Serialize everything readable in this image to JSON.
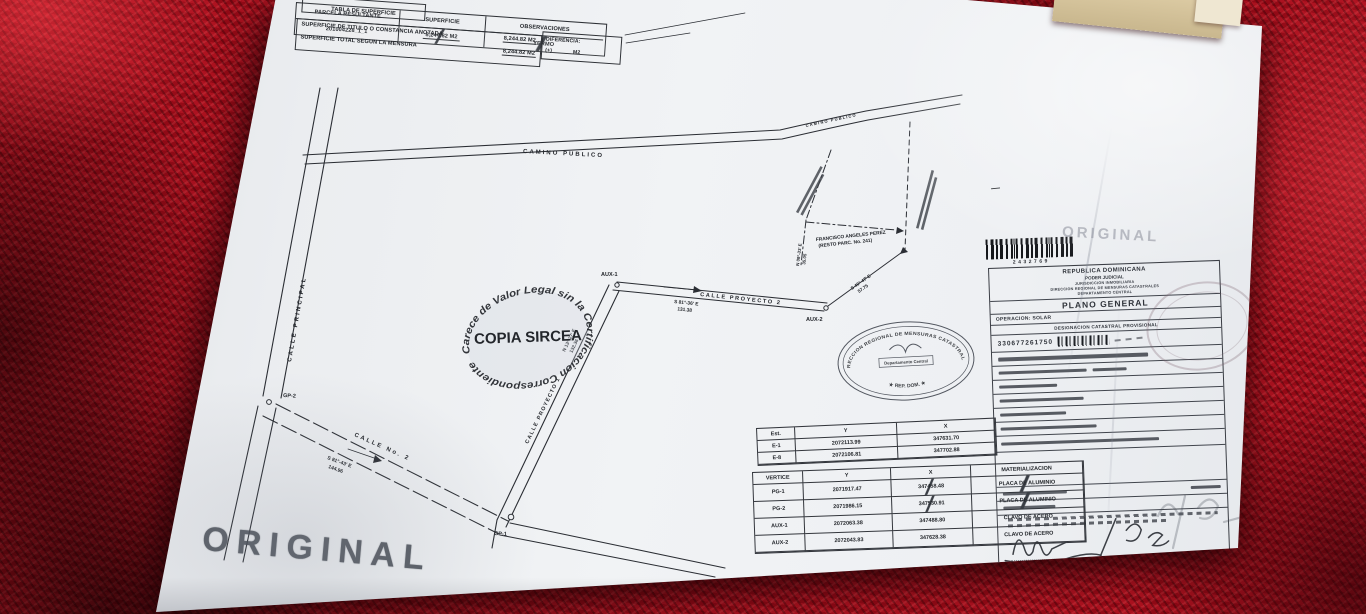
{
  "doc": {
    "title_box": "TABLA DE SUPERFICIE",
    "titulo_label": "SUPERFICIE DE TITULO O CONSTANCIA ANOTADA",
    "titulo_value": "8,244.82 M2",
    "mensura_label": "SUPERFICIE TOTAL SEGUN LA MENSURA",
    "mensura_value": "8,244.82 M2",
    "dif_label": "DIFERENCIA:",
    "dif_value": "(+) ______ M2",
    "h_parcela": "PARCELA RESULTANTE",
    "h_superficie": "SUPERFICIE",
    "h_obs": "OBSERVACIONES",
    "v_parcela": "201004228_1_1",
    "v_superficie": "8,244.82 M2",
    "v_obs": "YERMO"
  },
  "map": {
    "streets": {
      "camino": "CAMINO PUBLICO",
      "principal": "CALLE PRINCIPAL",
      "no2": "CALLE No. 2",
      "proy1": "CALLE PROYECTO 1",
      "proy2": "CALLE PROYECTO 2"
    },
    "points": {
      "gp1": "GP-1",
      "gp2": "GP-2",
      "aux1": "AUX-1",
      "aux2": "AUX-2"
    },
    "bearings": {
      "no2": {
        "b": "S 81°-43' E",
        "d": "144.96"
      },
      "proy1": {
        "b": "N 13°-27' E",
        "d": "132.36"
      },
      "proy2": {
        "b": "S 81°-36' E",
        "d": "131.38"
      },
      "diag": {
        "b": "S 46°-47' E",
        "d": "57.75"
      },
      "west": {
        "b": "N 09°-33' E",
        "d": "35.05"
      }
    },
    "neighbor": {
      "l1": "FRANCISCO ANGELES PEREZ",
      "l2": "(RESTO PARC. No. 241)"
    },
    "compass_n": "N"
  },
  "stamps": {
    "copia_arc": "Carece de Valor Legal sin la Certificacion Correspondiente",
    "copia_center": "COPIA SIRCEA",
    "seal_arc_top": "DIRECCION REGIONAL DE MENSURAS CATASTRALES",
    "seal_arc_bottom": "★ REP. DOM. ★",
    "seal_center": "Departamento Central",
    "original": "ORIGINAL"
  },
  "barcode": {
    "number": "2432769"
  },
  "panel": {
    "lines": [
      "REPUBLICA DOMINICANA",
      "PODER JUDICIAL",
      "JURISDICCION INMOBILIARIA",
      "DIRECCION REGIONAL DE MENSURAS CATASTRALES",
      "DEPARTAMENTO CENTRAL"
    ],
    "title": "PLANO GENERAL",
    "operacion": "OPERACION: SOLAR",
    "designacion": "DESIGNACION CATASTRAL PROVISIONAL",
    "numero": "330677261750",
    "agrimensor": "AGRIMENSOR"
  },
  "tables": {
    "est": {
      "headers": [
        "Est.",
        "Y",
        "X"
      ],
      "rows": [
        [
          "E-1",
          "2072113.99",
          "347631.70"
        ],
        [
          "E-8",
          "2072106.81",
          "347702.88"
        ]
      ]
    },
    "vert": {
      "headers": [
        "VERTICE",
        "Y",
        "X",
        "MATERIALIZACION"
      ],
      "rows": [
        [
          "PG-1",
          "2071917.47",
          "347458.48",
          "PLACA DE ALUMINIO"
        ],
        [
          "PG-2",
          "2071986.15",
          "347530.91",
          "PLACA DE ALUMINIO"
        ],
        [
          "AUX-1",
          "2072063.38",
          "347488.80",
          "CLAVO DE ACERO"
        ],
        [
          "AUX-2",
          "2072043.83",
          "347628.38",
          "CLAVO DE ACERO"
        ]
      ]
    }
  }
}
